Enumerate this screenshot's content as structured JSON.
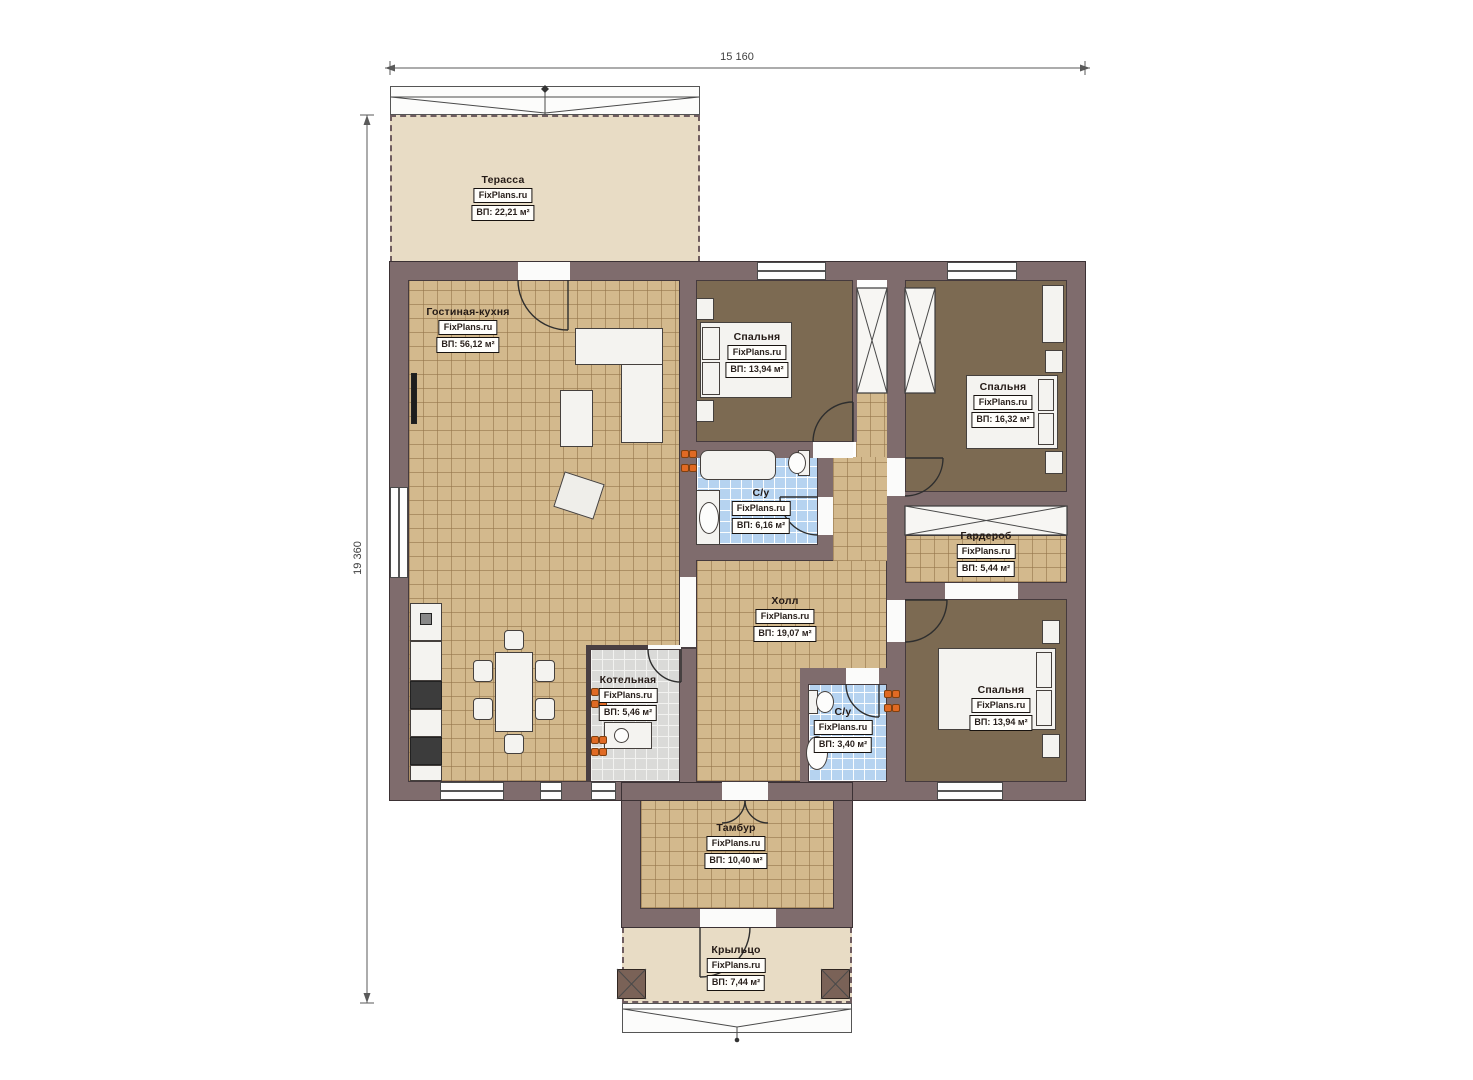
{
  "brand": "FixPlans.ru",
  "dimensions": {
    "width_label": "15 160",
    "height_label": "19 360"
  },
  "rooms": [
    {
      "id": "terrace",
      "name": "Терасса",
      "area": "ВП: 22,21 м²"
    },
    {
      "id": "living-kitchen",
      "name": "Гостиная-кухня",
      "area": "ВП: 56,12 м²"
    },
    {
      "id": "bedroom-1",
      "name": "Спальня",
      "area": "ВП: 13,94 м²"
    },
    {
      "id": "bedroom-2",
      "name": "Спальня",
      "area": "ВП: 16,32 м²"
    },
    {
      "id": "bathroom-1",
      "name": "С/у",
      "area": "ВП: 6,16 м²"
    },
    {
      "id": "wardrobe",
      "name": "Гардероб",
      "area": "ВП: 5,44 м²"
    },
    {
      "id": "hall",
      "name": "Холл",
      "area": "ВП: 19,07 м²"
    },
    {
      "id": "boiler",
      "name": "Котельная",
      "area": "ВП: 5,46 м²"
    },
    {
      "id": "bathroom-2",
      "name": "С/у",
      "area": "ВП: 3,40 м²"
    },
    {
      "id": "bedroom-3",
      "name": "Спальня",
      "area": "ВП: 13,94 м²"
    },
    {
      "id": "vestibule",
      "name": "Тамбур",
      "area": "ВП: 10,40 м²"
    },
    {
      "id": "porch",
      "name": "Крыльцо",
      "area": "ВП: 7,44 м²"
    }
  ],
  "colors": {
    "wall": "#7f6c6d",
    "floor_tile": "#d3b98d",
    "bedroom_floor": "#7c6a52",
    "bathroom_tile": "#b6d3f0",
    "boiler_tile": "#dadad8",
    "terrace_floor": "#e8dcc5",
    "radiator_orange": "#e06a24"
  }
}
